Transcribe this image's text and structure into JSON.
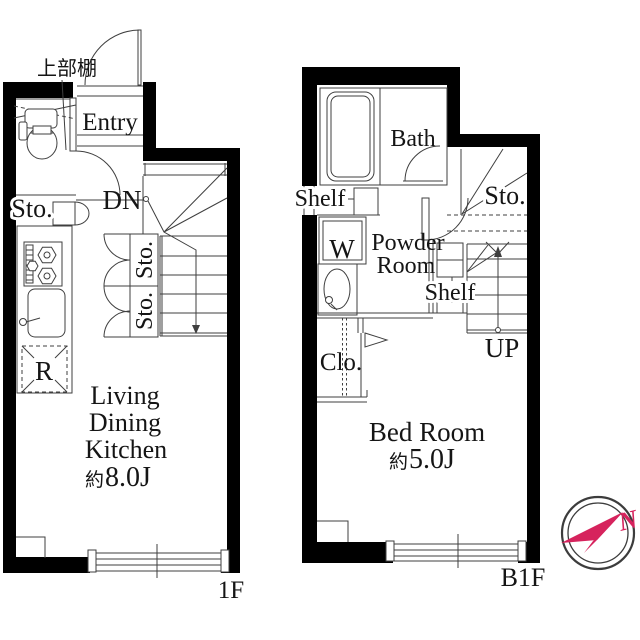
{
  "plan_1f": {
    "floor_label": "1F",
    "upper_shelf": "上部棚",
    "entry": "Entry",
    "down": "DN",
    "storage_hall": "Sto.",
    "stair_storage_upper": "Sto.",
    "stair_storage_lower": "Sto.",
    "refrigerator": "R",
    "room_name_lines": [
      "Living",
      "Dining",
      "Kitchen"
    ],
    "room_size_prefix": "約",
    "room_size_value": "8.0J"
  },
  "plan_b1f": {
    "floor_label": "B1F",
    "bath": "Bath",
    "shelf_left": "Shelf",
    "washer": "W",
    "powder_room_lines": [
      "Powder",
      "Room"
    ],
    "understair_storage": "Sto.",
    "shelf_stair": "Shelf",
    "up": "UP",
    "closet": "Clo.",
    "room_name": "Bed Room",
    "room_size_prefix": "約",
    "room_size_value": "5.0J"
  },
  "compass": {
    "north": "N",
    "arrow_color": "#d6235d"
  }
}
